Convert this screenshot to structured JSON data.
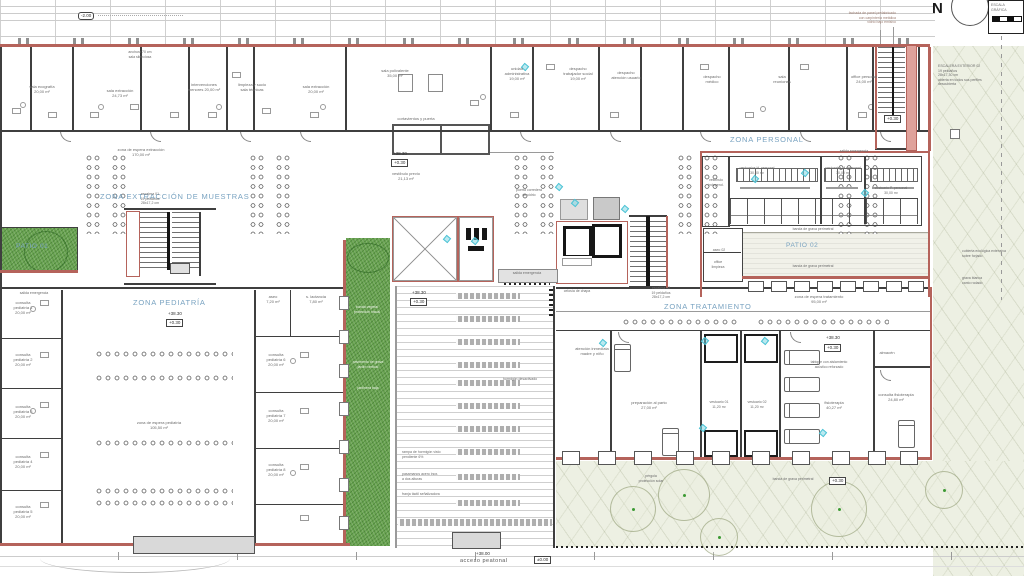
{
  "compass": {
    "north": "N"
  },
  "scale_bar": {
    "title": "ESCALA GRÁFICA"
  },
  "zones": {
    "extraccion": "ZONA EXTRACCIÓN DE MUESTRAS",
    "pediatria": "ZONA PEDIATRÍA",
    "personal": "ZONA PERSONAL",
    "tratamiento": "ZONA TRATAMIENTO",
    "patio01": "PATIO 01",
    "patio02": "PATIO 02"
  },
  "levels": {
    "upper_floor": "+38.30",
    "entry": "+0.30",
    "ground": "±0.00",
    "street": "+38.00",
    "basement": "-2.00"
  },
  "access": {
    "pedestrian": "acceso peatonal"
  },
  "annotations": [
    {
      "name": "label-sala-ecografia",
      "text": "sala ecografía\n20,00 m²",
      "x": 22,
      "y": 84,
      "w": 40
    },
    {
      "name": "label-sala-extraccion-1",
      "text": "sala extracción\n24,73 m²",
      "x": 96,
      "y": 88,
      "w": 48
    },
    {
      "name": "label-intervenciones",
      "text": "intervenciones\nmenores 20,00 m²",
      "x": 182,
      "y": 82,
      "w": 44
    },
    {
      "name": "label-limpieza-sucio",
      "text": "limpieza y sucio\nsala técnicas",
      "x": 228,
      "y": 82,
      "w": 48
    },
    {
      "name": "label-sala-extraccion-2",
      "text": "sala extracción\n20,00 m²",
      "x": 294,
      "y": 84,
      "w": 44
    },
    {
      "name": "label-mostrador",
      "text": "anchura 70 cm\nsala silenciosa",
      "x": 118,
      "y": 50,
      "w": 44,
      "cls": "tiny"
    },
    {
      "name": "label-sala-polivalente",
      "text": "sala polivalente\n35,00 m²",
      "x": 372,
      "y": 68,
      "w": 46
    },
    {
      "name": "label-unidad-admin",
      "text": "unidad\nadministrativa\n19,00 m²",
      "x": 498,
      "y": 66,
      "w": 38
    },
    {
      "name": "label-despacho-social",
      "text": "despacho\ntrabajador social\n19,00 m²",
      "x": 556,
      "y": 66,
      "w": 44
    },
    {
      "name": "label-despacho-usuario",
      "text": "despacho\natención usuario",
      "x": 604,
      "y": 70,
      "w": 44
    },
    {
      "name": "label-despacho-medico",
      "text": "despacho\nmédico",
      "x": 694,
      "y": 74,
      "w": 36
    },
    {
      "name": "label-sala-reuniones",
      "text": "sala\nreuniones",
      "x": 764,
      "y": 74,
      "w": 36
    },
    {
      "name": "label-office-personal",
      "text": "office personal\n24,00 m²",
      "x": 842,
      "y": 74,
      "w": 44
    },
    {
      "name": "label-espera-extraccion",
      "text": "zona de espera extracción\n170,00 m²",
      "x": 108,
      "y": 147,
      "w": 66
    },
    {
      "name": "label-escalera-01",
      "text": "escalera 01\n19 peldaños\n28x17,2 cm",
      "x": 130,
      "y": 192,
      "w": 40,
      "cls": "tiny"
    },
    {
      "name": "label-cortavientos",
      "text": "cortavientos y puerta",
      "x": 388,
      "y": 116,
      "w": 56
    },
    {
      "name": "label-vestibulo-previo",
      "text": "vestíbulo previo\n21,13 m²",
      "x": 384,
      "y": 171,
      "w": 44
    },
    {
      "name": "label-puerta-corredera",
      "text": "puerta corredera\nde vidrio",
      "x": 506,
      "y": 188,
      "w": 46,
      "cls": "tiny"
    },
    {
      "name": "label-salida-emergencia-centro",
      "text": "salida emergencia",
      "x": 500,
      "y": 271,
      "w": 54,
      "cls": "tiny"
    },
    {
      "name": "label-salida-emergencia-oeste",
      "text": "salida emergencia",
      "x": 10,
      "y": 291,
      "w": 48,
      "cls": "tiny"
    },
    {
      "name": "label-espera-pediatria",
      "text": "zona de espera pediatría\n105,50 m²",
      "x": 124,
      "y": 420,
      "w": 70
    },
    {
      "name": "label-consulta-ped-1",
      "text": "consulta\npediatría 1\n20,00 m²",
      "x": 6,
      "y": 300,
      "w": 34
    },
    {
      "name": "label-consulta-ped-2",
      "text": "consulta\npediatría 2\n20,00 m²",
      "x": 6,
      "y": 352,
      "w": 34
    },
    {
      "name": "label-consulta-ped-3",
      "text": "consulta\npediatría 3\n20,00 m²",
      "x": 6,
      "y": 404,
      "w": 34
    },
    {
      "name": "label-consulta-ped-4",
      "text": "consulta\npediatría 4\n20,00 m²",
      "x": 6,
      "y": 454,
      "w": 34
    },
    {
      "name": "label-consulta-ped-5",
      "text": "consulta\npediatría 5\n20,00 m²",
      "x": 6,
      "y": 504,
      "w": 34
    },
    {
      "name": "label-aseo-pediatria",
      "text": "aseo\n7,20 m²",
      "x": 260,
      "y": 294,
      "w": 26
    },
    {
      "name": "label-lactancia",
      "text": "s. lactancia\n7,80 m²",
      "x": 296,
      "y": 294,
      "w": 40
    },
    {
      "name": "label-consulta-ped-6",
      "text": "consulta\npediatría 6\n20,00 m²",
      "x": 258,
      "y": 352,
      "w": 36
    },
    {
      "name": "label-consulta-ped-7",
      "text": "consulta\npediatría 7\n20,00 m²",
      "x": 258,
      "y": 408,
      "w": 36
    },
    {
      "name": "label-consulta-ped-8",
      "text": "consulta\npediatría 8\n20,00 m²",
      "x": 258,
      "y": 462,
      "w": 36
    },
    {
      "name": "label-banda-vegetal",
      "text": "banda vegetal\nprotección visual",
      "x": 346,
      "y": 305,
      "w": 42,
      "cls": "wt tiny"
    },
    {
      "name": "label-grava-jardin",
      "text": "pavimento de grava\njardín vertical",
      "x": 347,
      "y": 360,
      "w": 42,
      "cls": "wt tiny"
    },
    {
      "name": "label-jardinera",
      "text": "jardinera baja",
      "x": 348,
      "y": 386,
      "w": 40,
      "cls": "wt tiny"
    },
    {
      "name": "label-hormigon",
      "text": "hormigón desactivado",
      "x": 492,
      "y": 377,
      "w": 56,
      "cls": "tiny"
    },
    {
      "name": "label-rampa",
      "text": "rampa de hormigón visto\npendiente 6%",
      "x": 402,
      "y": 450,
      "w": 56,
      "cls": "tiny left"
    },
    {
      "name": "label-pasamanos",
      "text": "pasamanos acero inox.\na dos alturas",
      "x": 402,
      "y": 472,
      "w": 56,
      "cls": "tiny left"
    },
    {
      "name": "label-franja-tactil",
      "text": "franja táctil señalizadora",
      "x": 402,
      "y": 492,
      "w": 60,
      "cls": "tiny left"
    },
    {
      "name": "label-escalera-02",
      "text": "escalera 02\n19 peldaños\n28x17,2 cm",
      "x": 642,
      "y": 286,
      "w": 38,
      "cls": "tiny"
    },
    {
      "name": "label-espera-tratamiento",
      "text": "zona de espera tratamiento\n95,00 m²",
      "x": 784,
      "y": 294,
      "w": 70
    },
    {
      "name": "label-celosia",
      "text": "celosía de chapa",
      "x": 556,
      "y": 289,
      "w": 42,
      "cls": "tiny"
    },
    {
      "name": "label-atencion-inmediata",
      "text": "atención inmediata\nmadre y niño",
      "x": 568,
      "y": 346,
      "w": 48
    },
    {
      "name": "label-preparacion-parto",
      "text": "preparación al parto\n27,00 m²",
      "x": 622,
      "y": 400,
      "w": 54
    },
    {
      "name": "label-vestuario-01",
      "text": "vestuario 01\n11,20 m²",
      "x": 702,
      "y": 400,
      "w": 34,
      "cls": "tiny"
    },
    {
      "name": "label-vestuario-02",
      "text": "vestuario 02\n11,20 m²",
      "x": 740,
      "y": 400,
      "w": 34,
      "cls": "tiny"
    },
    {
      "name": "label-fisioterapia",
      "text": "fisioterapia\n40,27 m²",
      "x": 814,
      "y": 400,
      "w": 40
    },
    {
      "name": "label-almacen",
      "text": "almacén",
      "x": 872,
      "y": 350,
      "w": 30
    },
    {
      "name": "label-consulta-fisio",
      "text": "consulta fisioterapia\n24,80 m²",
      "x": 872,
      "y": 392,
      "w": 48
    },
    {
      "name": "label-tabique",
      "text": "tabique con aislamiento\nacústico reforzado",
      "x": 798,
      "y": 360,
      "w": 62,
      "cls": "tiny"
    },
    {
      "name": "label-vestuarios-h",
      "text": "vestuarios H. personal\n30,00 m²",
      "x": 732,
      "y": 166,
      "w": 50,
      "cls": "tiny"
    },
    {
      "name": "label-vestuarios-m",
      "text": "vestuarios M. personal\n30,00 m²",
      "x": 820,
      "y": 166,
      "w": 46,
      "cls": "tiny"
    },
    {
      "name": "label-vestuario-p",
      "text": "vestuario P. personal\n30,00 m²",
      "x": 868,
      "y": 186,
      "w": 46,
      "cls": "tiny"
    },
    {
      "name": "label-vestibulo-indep",
      "text": "vestíbulo\nindepend.",
      "x": 702,
      "y": 178,
      "w": 28,
      "cls": "tiny"
    },
    {
      "name": "label-aseo-02",
      "text": "aseo 02",
      "x": 706,
      "y": 248,
      "w": 26,
      "cls": "tiny"
    },
    {
      "name": "label-office-limpieza",
      "text": "office\nlimpieza",
      "x": 704,
      "y": 260,
      "w": 28,
      "cls": "tiny"
    },
    {
      "name": "label-grava-1",
      "text": "banda de grava perimetral",
      "x": 782,
      "y": 227,
      "w": 62,
      "cls": "tiny"
    },
    {
      "name": "label-grava-2",
      "text": "banda de grava perimetral",
      "x": 782,
      "y": 264,
      "w": 62,
      "cls": "tiny"
    },
    {
      "name": "label-grava-3",
      "text": "banda de grava perimetral",
      "x": 762,
      "y": 477,
      "w": 62,
      "cls": "tiny"
    },
    {
      "name": "label-pergola",
      "text": "pérgola\nprotección solar",
      "x": 628,
      "y": 474,
      "w": 46,
      "cls": "tiny"
    },
    {
      "name": "label-escalera-ext",
      "text": "ESCALERA EXTERIOR 02\n19 peldaños\n28x17,30 cm\nabierta en todos sus perfiles\ndescubierta",
      "x": 938,
      "y": 64,
      "w": 60,
      "cls": "tiny left"
    },
    {
      "name": "label-cubierta-eco",
      "text": "cubierta ecológica extensiva\nsobre forjado",
      "x": 962,
      "y": 249,
      "w": 58,
      "cls": "tiny left"
    },
    {
      "name": "label-grava-blanca",
      "text": "grava blanca\ncanto rodado",
      "x": 962,
      "y": 276,
      "w": 50,
      "cls": "tiny left"
    },
    {
      "name": "label-fachada",
      "text": "fachada de panel prefabricado\ncon carpintería metálica\nvidrio bajo emisivo",
      "x": 806,
      "y": 11,
      "w": 90,
      "cls": "tiny brn right"
    },
    {
      "name": "label-salida-emergencia-ne",
      "text": "salida emergencia",
      "x": 830,
      "y": 149,
      "w": 48,
      "cls": "tiny"
    }
  ]
}
